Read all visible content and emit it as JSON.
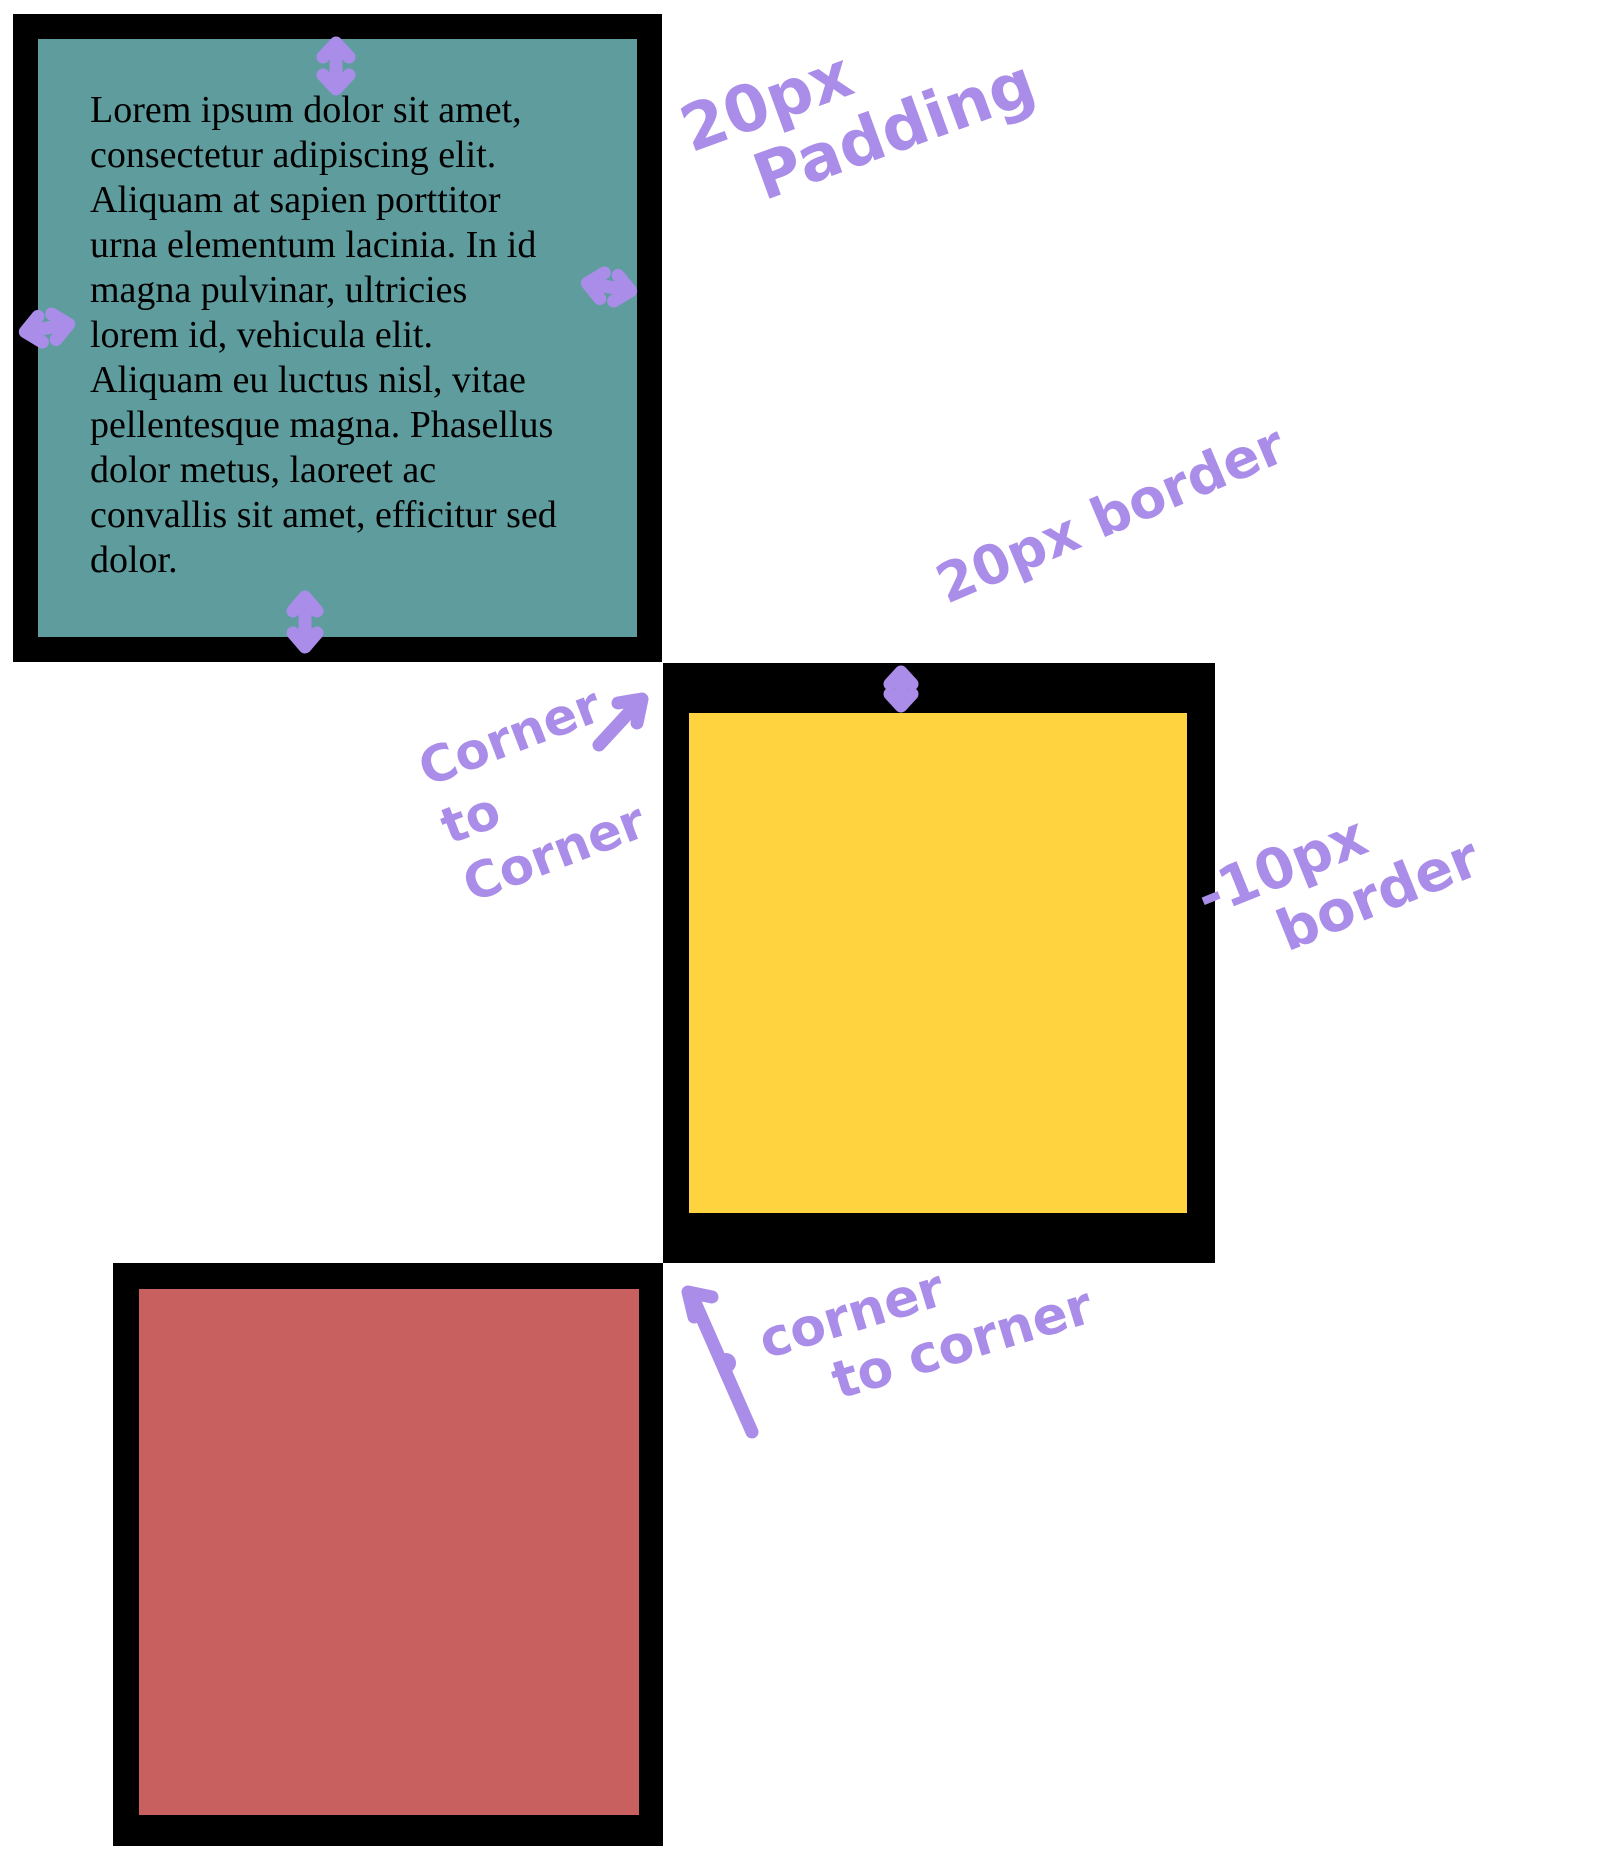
{
  "canvas": {
    "width": 1622,
    "height": 1866,
    "background": "#ffffff"
  },
  "boxes": {
    "teal": {
      "fill": "#5F9C9E",
      "border_color": "#000000",
      "text": "Lorem ipsum dolor sit amet,\nconsectetur adipiscing elit.\nAliquam at sapien porttitor\nurna elementum lacinia. In id\nmagna pulvinar, ultricies\nlorem id, vehicula elit.\nAliquam eu luctus nisl, vitae\npellentesque magna. Phasellus\ndolor metus, laoreet ac\nconvallis sit amet, efficitur sed\ndolor."
    },
    "yellow": {
      "fill": "#FFD23F",
      "border_color": "#000000"
    },
    "red": {
      "fill": "#C96060",
      "border_color": "#000000"
    }
  },
  "annotations": {
    "ink_color": "#A98DE9",
    "padding_label": {
      "line1": "20px",
      "line2": "Padding"
    },
    "border20_label": {
      "text": "20px border"
    },
    "border10_label": {
      "line1": "-10px",
      "line2": "border"
    },
    "corner_label_top": {
      "line1": "Corner",
      "line2": "to",
      "line3": "Corner"
    },
    "corner_label_bottom": {
      "line1": "corner",
      "line2": "to corner"
    }
  }
}
